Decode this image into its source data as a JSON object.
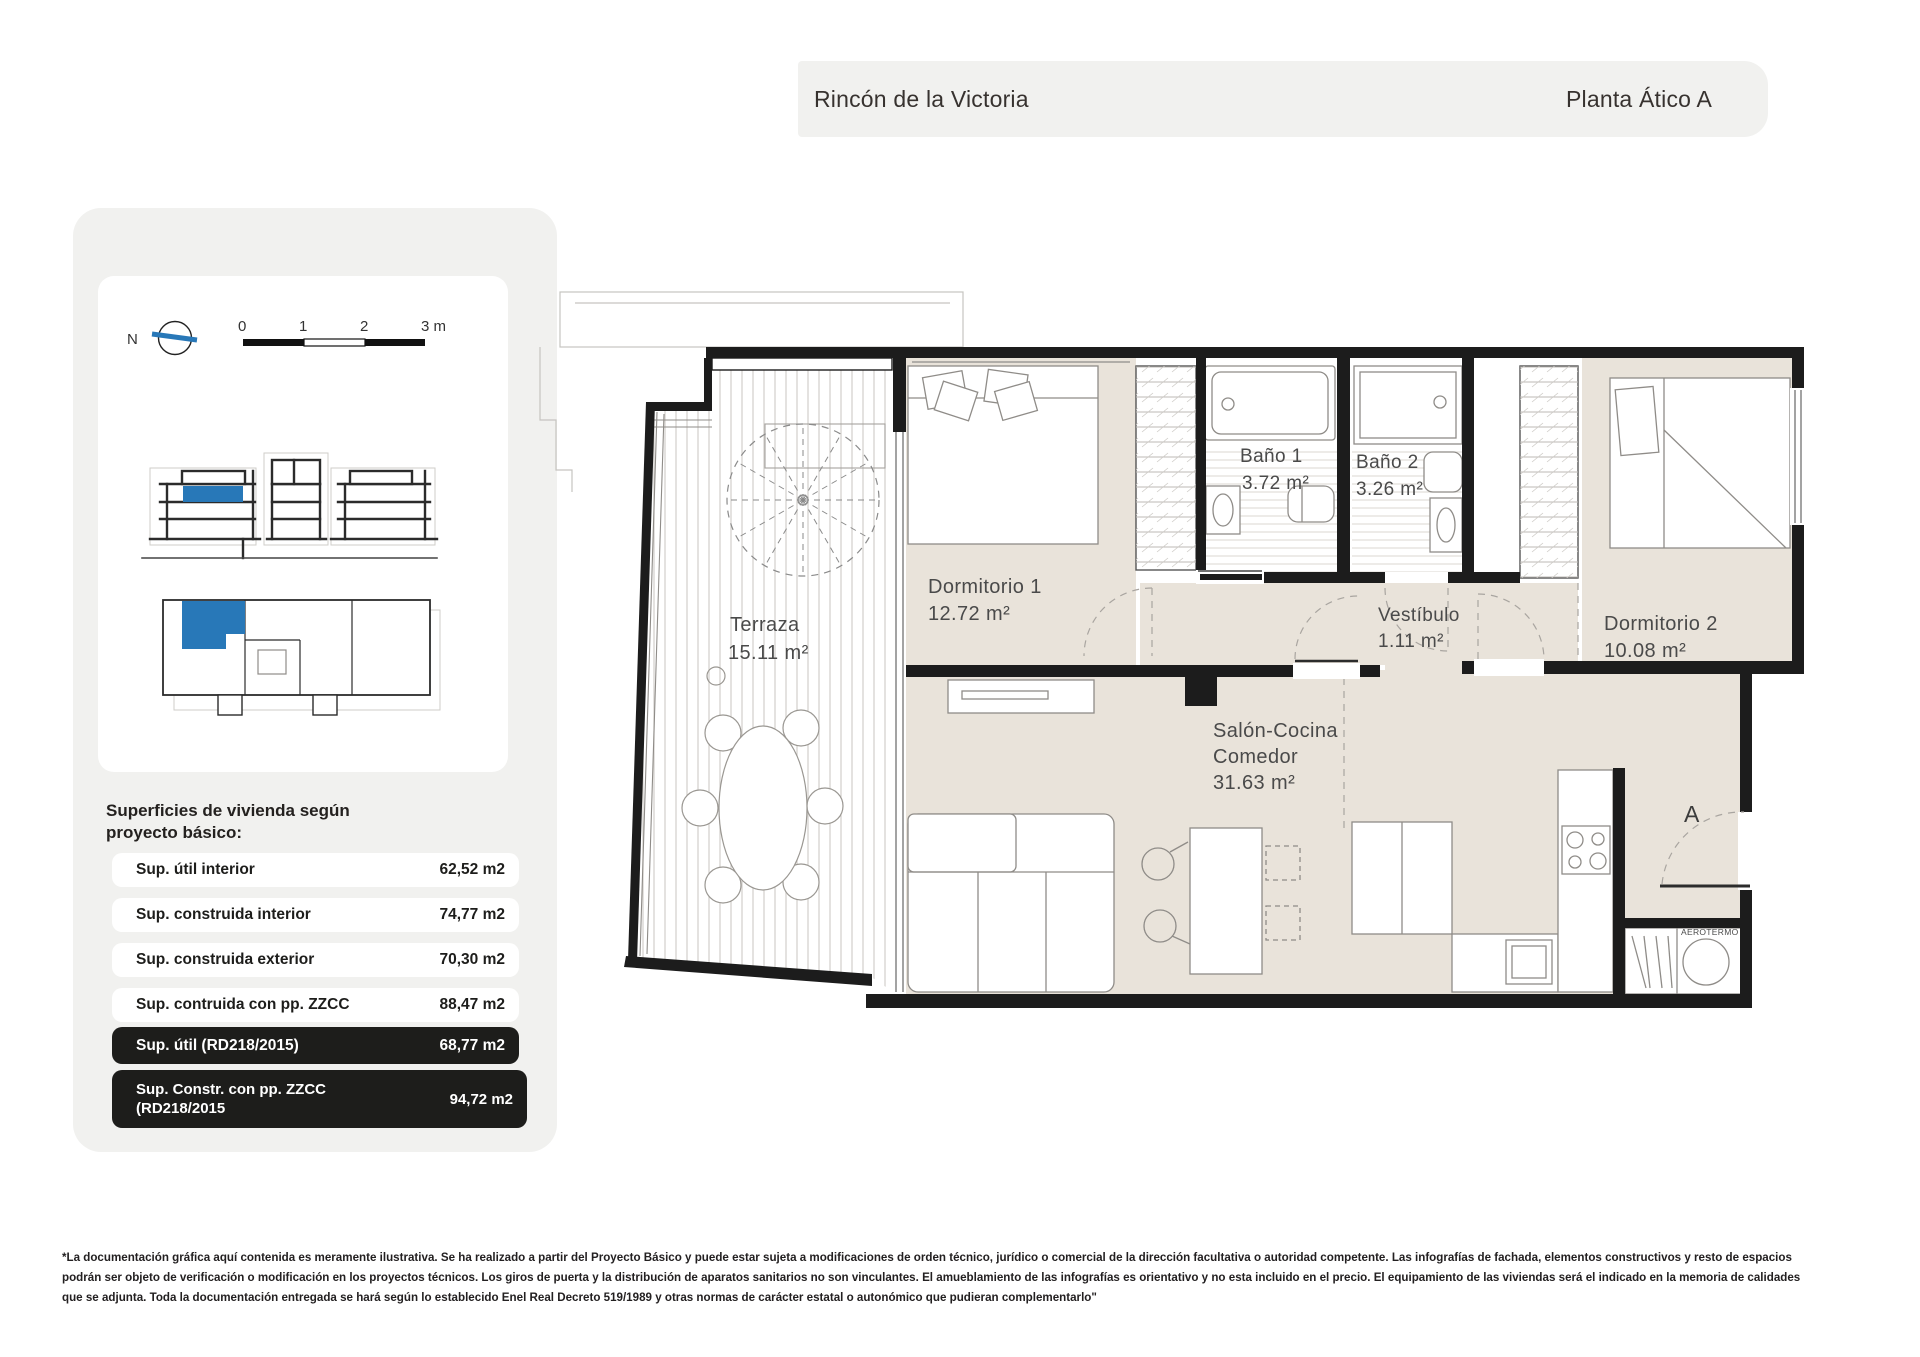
{
  "header": {
    "project": "Rincón de la Victoria",
    "plan": "Planta Ático A"
  },
  "sidebar": {
    "compass_label": "N",
    "scale": {
      "ticks": [
        "0",
        "1",
        "2",
        "3 m"
      ]
    },
    "surfaces_title_line1": "Superficies de vivienda según",
    "surfaces_title_line2": "proyecto básico:",
    "rows": [
      {
        "label": "Sup. útil interior",
        "value": "62,52 m2",
        "dark": false
      },
      {
        "label": "Sup. construida interior",
        "value": "74,77 m2",
        "dark": false
      },
      {
        "label": "Sup. construida exterior",
        "value": "70,30 m2",
        "dark": false
      },
      {
        "label": "Sup. contruida con pp. ZZCC",
        "value": "88,47 m2",
        "dark": false
      },
      {
        "label": "Sup. útil (RD218/2015)",
        "value": "68,77 m2",
        "dark": true
      },
      {
        "label_line1": "Sup. Constr. con pp. ZZCC",
        "label_line2": "(RD218/2015",
        "value": "94,72 m2",
        "dark": true
      }
    ]
  },
  "floorplan": {
    "rooms": [
      {
        "name": "Terraza",
        "area": "15.11 m²"
      },
      {
        "name": "Dormitorio 1",
        "area": "12.72 m²"
      },
      {
        "name": "Baño 1",
        "area": "3.72 m²"
      },
      {
        "name": "Baño 2",
        "area": "3.26 m²"
      },
      {
        "name": "Vestíbulo",
        "area": "1.11 m²"
      },
      {
        "name": "Dormitorio 2",
        "area": "10.08 m²"
      },
      {
        "name": "Salón-Cocina",
        "name2": "Comedor",
        "area": "31.63 m²"
      }
    ],
    "entrance_label": "A",
    "aerotermo_label": "AEROTERMO"
  },
  "colors": {
    "accent_blue": "#2878b8",
    "beige": "#e9e3da",
    "panel_gray": "#f1f1ef",
    "dark_row": "#1d1d1b",
    "wall": "#1c1c1c"
  },
  "disclaimer": {
    "line1": "*La documentación gráfica aquí contenida es meramente ilustrativa. Se ha realizado a partir del Proyecto Básico y puede estar sujeta a modificaciones de orden técnico, jurídico o comercial de la dirección facultativa o autoridad competente. Las infografías de fachada, elementos constructivos y resto de espacios",
    "line2": "podrán ser objeto de verificación o modificación en los proyectos técnicos. Los giros de puerta y la distribución de aparatos sanitarios no son vinculantes. El amueblamiento de las infografías es orientativo y no esta incluido en el precio. El equipamiento de las viviendas será el indicado en la memoria de calidades",
    "line3": "que se adjunta. Toda la documentación entregada se hará según lo establecido Enel Real Decreto 519/1989 y otras normas de carácter estatal o autonómico que pudieran complementarlo\""
  }
}
